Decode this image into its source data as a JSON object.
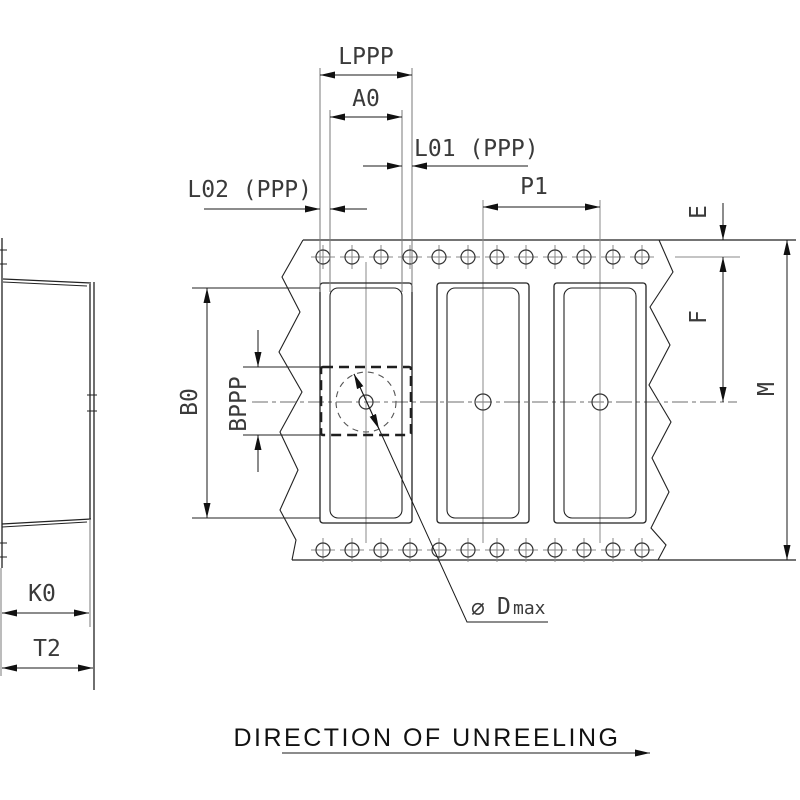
{
  "drawing_type": "technical-drawing-tape-and-reel",
  "labels": {
    "lppp": "LPPP",
    "a0": "A0",
    "l01": "L01 (PPP)",
    "l02": "L02 (PPP)",
    "p1": "P1",
    "e": "E",
    "f": "F",
    "m": "M",
    "b0": "B0",
    "bppp": "BPPP",
    "k0": "K0",
    "t2": "T2",
    "diameter_symbol": "∅",
    "diameter_name": "D",
    "diameter_subscript": "max"
  },
  "caption": {
    "text": "DIRECTION OF UNREELING"
  },
  "colors": {
    "line": "#222222",
    "centerline": "#8a8a8a",
    "text": "#3a3a3a",
    "arrow": "#111111",
    "background": "#ffffff"
  }
}
